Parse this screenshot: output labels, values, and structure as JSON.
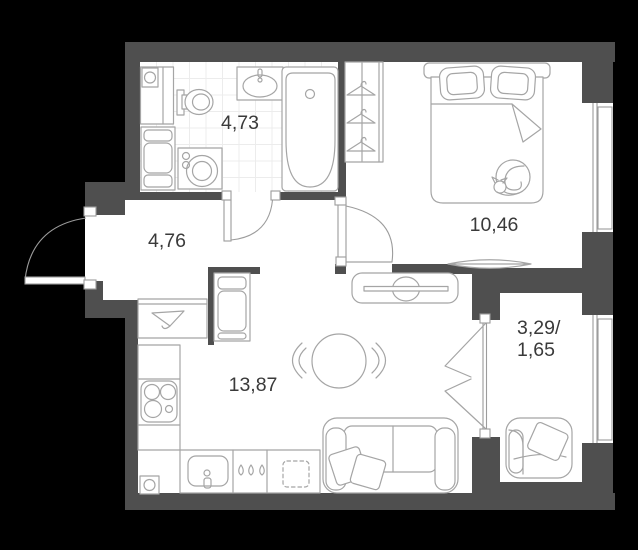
{
  "plan": {
    "title": "apartment-floor-plan",
    "rooms": [
      {
        "id": "bathroom",
        "area": "4,73"
      },
      {
        "id": "hallway",
        "area": "4,76"
      },
      {
        "id": "bedroom",
        "area": "10,46"
      },
      {
        "id": "living-kitchen",
        "area": "13,87"
      },
      {
        "id": "balcony",
        "area_line1": "3,29/",
        "area_line2": "1,65"
      }
    ],
    "colors": {
      "wall": "#4f4f4f",
      "floor": "#ffffff",
      "background": "#000000",
      "furniture_stroke": "#a5a5a5",
      "text": "#3a3a3a",
      "tile_grid": "#ececec"
    }
  }
}
